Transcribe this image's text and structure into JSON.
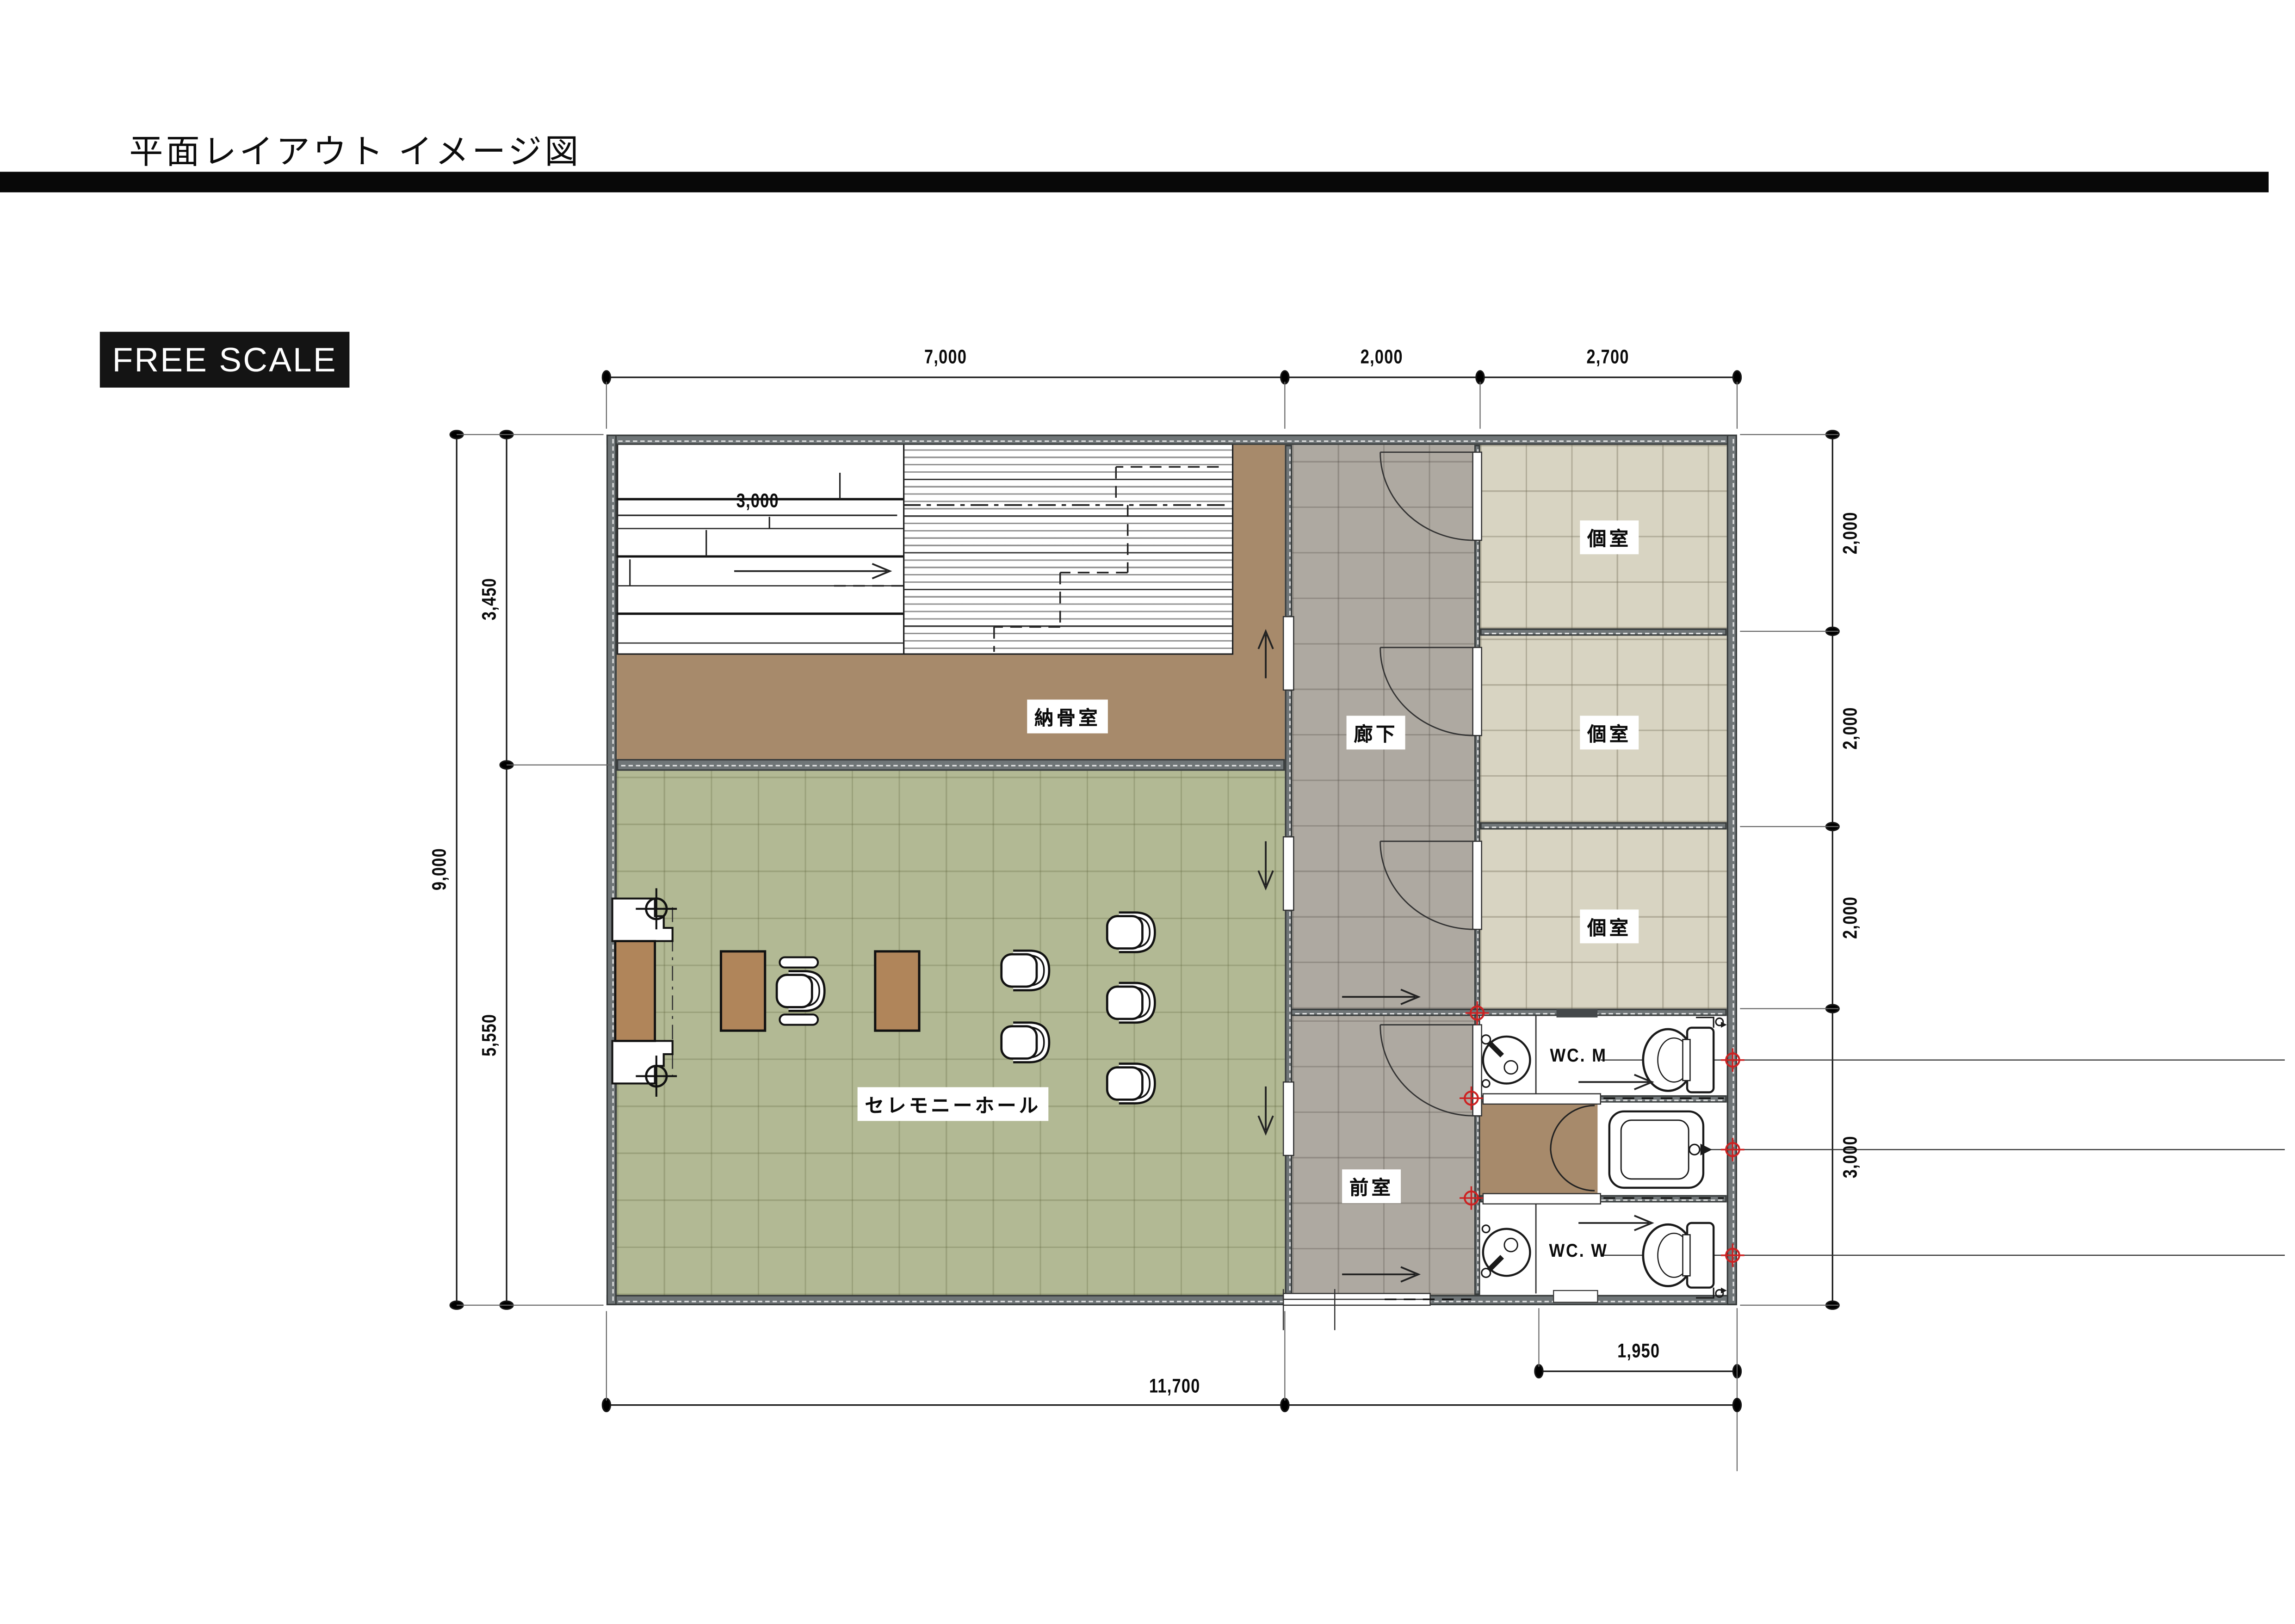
{
  "page": {
    "title": "平面レイアウト イメージ図",
    "scale_label": "FREE SCALE"
  },
  "rooms": {
    "nokotsu": "納骨室",
    "hall": "セレモニーホール",
    "corridor": "廊下",
    "koshitsu": [
      "個室",
      "個室",
      "個室"
    ],
    "zenshitsu": "前室",
    "wc_m": "WC. M",
    "wc_w": "WC. W"
  },
  "dimensions": {
    "top": [
      "7,000",
      "2,000",
      "2,700"
    ],
    "left": {
      "total": "9,000",
      "upper": "3,450",
      "lower": "5,550"
    },
    "right": [
      "2,000",
      "2,000",
      "2,000",
      "3,000"
    ],
    "bottom": {
      "total": "11,700",
      "wc_width": "1,950"
    },
    "interior_shelf": "3,000"
  },
  "colors": {
    "wall": "#6f7577",
    "ossuary_floor": "#a78a6b",
    "hall_floor": "#b2b994",
    "corridor_floor": "#aea9a1",
    "private_room_floor": "#d8d4c2",
    "furniture_wood": "#b0855a",
    "marker_red": "#cc2222",
    "bar_black": "#080808"
  }
}
